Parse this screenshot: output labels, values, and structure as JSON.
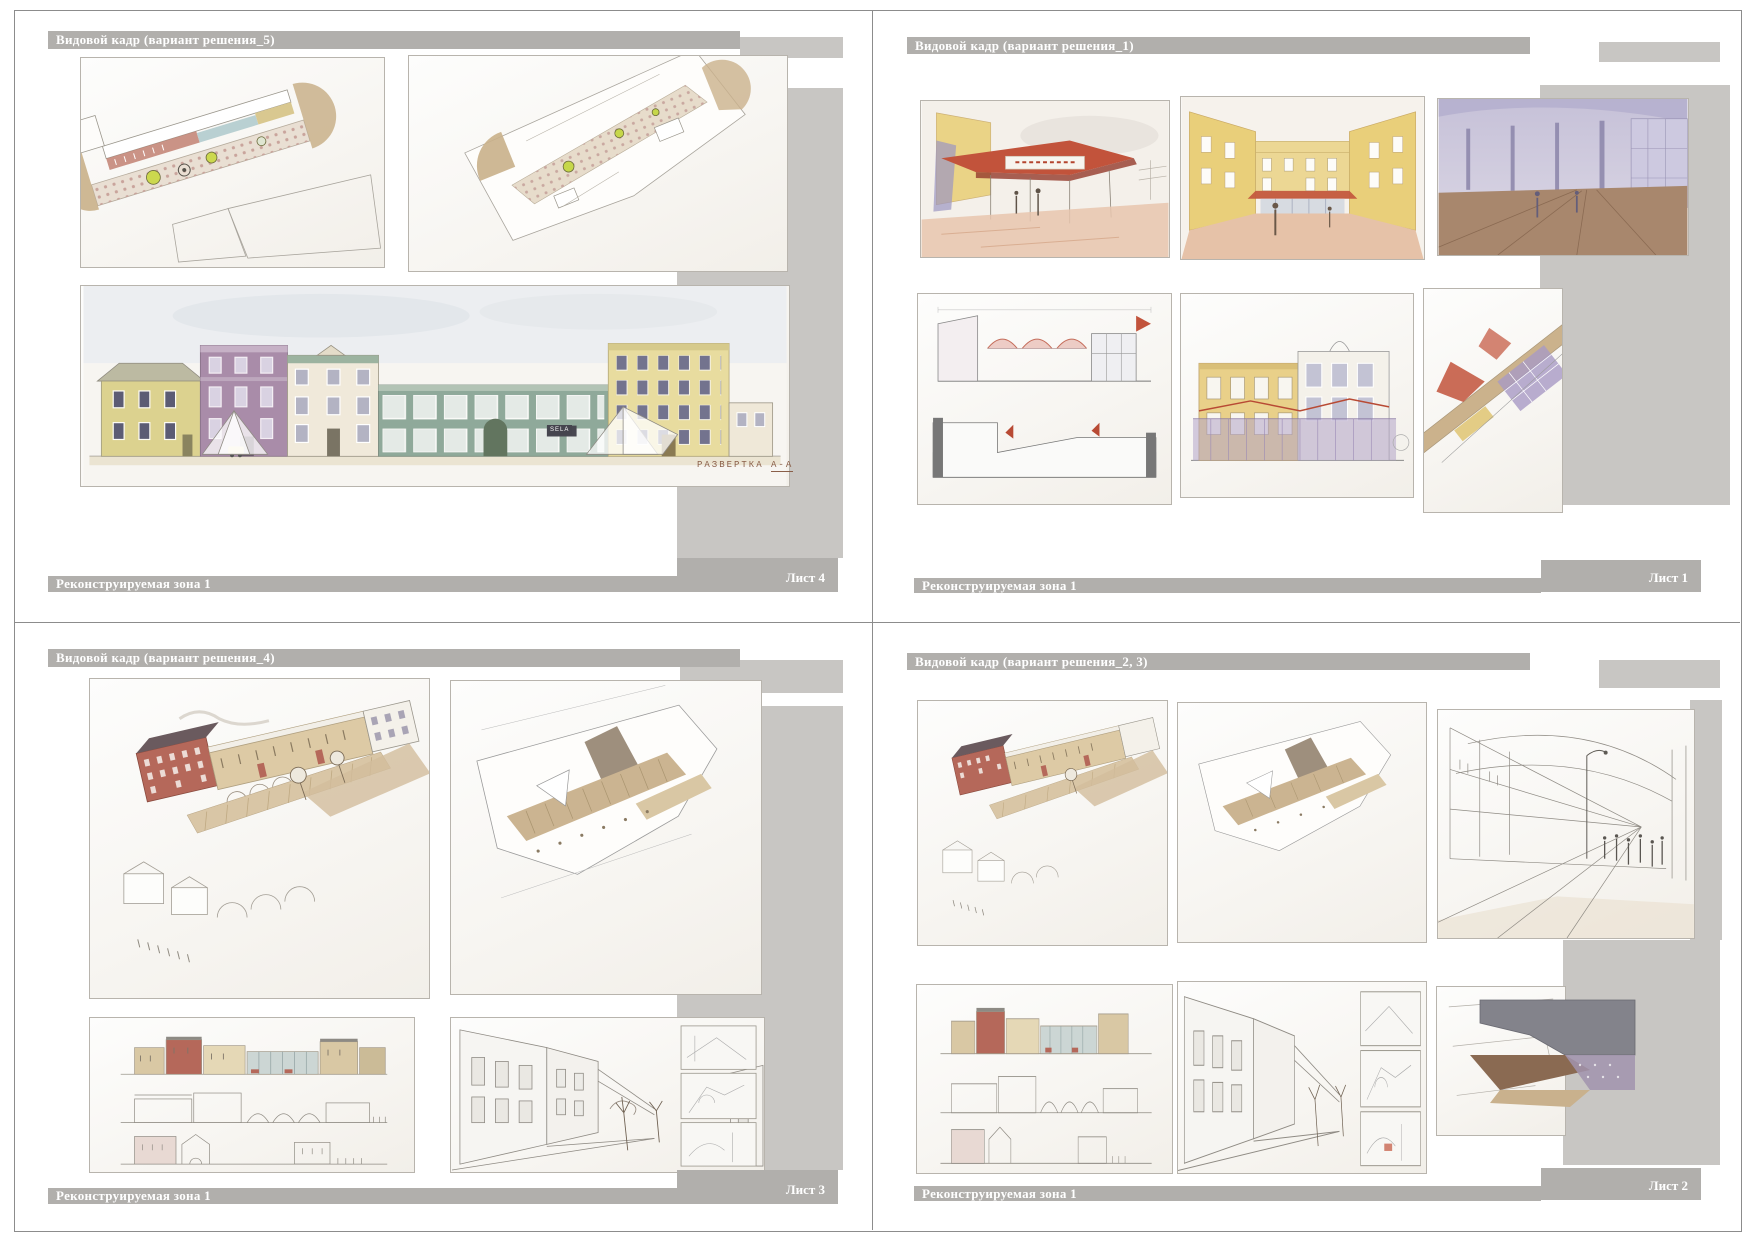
{
  "sheets": [
    {
      "header": "Видовой кадр (вариант решения_5)",
      "footer_zone": "Реконструируемая зона 1",
      "sheet_label": "Лист 4",
      "caption_label": "РАЗВЕРТКА",
      "caption_ref": "А-А",
      "storefront_sign": "SELA"
    },
    {
      "header": "Видовой кадр (вариант решения_1)",
      "footer_zone": "Реконструируемая зона 1",
      "sheet_label": "Лист 1"
    },
    {
      "header": "Видовой кадр (вариант решения_4)",
      "footer_zone": "Реконструируемая зона 1",
      "sheet_label": "Лист 3"
    },
    {
      "header": "Видовой кадр (вариант решения_2, 3)",
      "footer_zone": "Реконструируемая зона 1",
      "sheet_label": "Лист 2"
    }
  ],
  "colors": {
    "title_bar_gray": "#b1afac",
    "decor_band_gray": "#c8c6c3",
    "divider_gray": "#8c8c8c",
    "caption_brown": "#8a5f49"
  }
}
